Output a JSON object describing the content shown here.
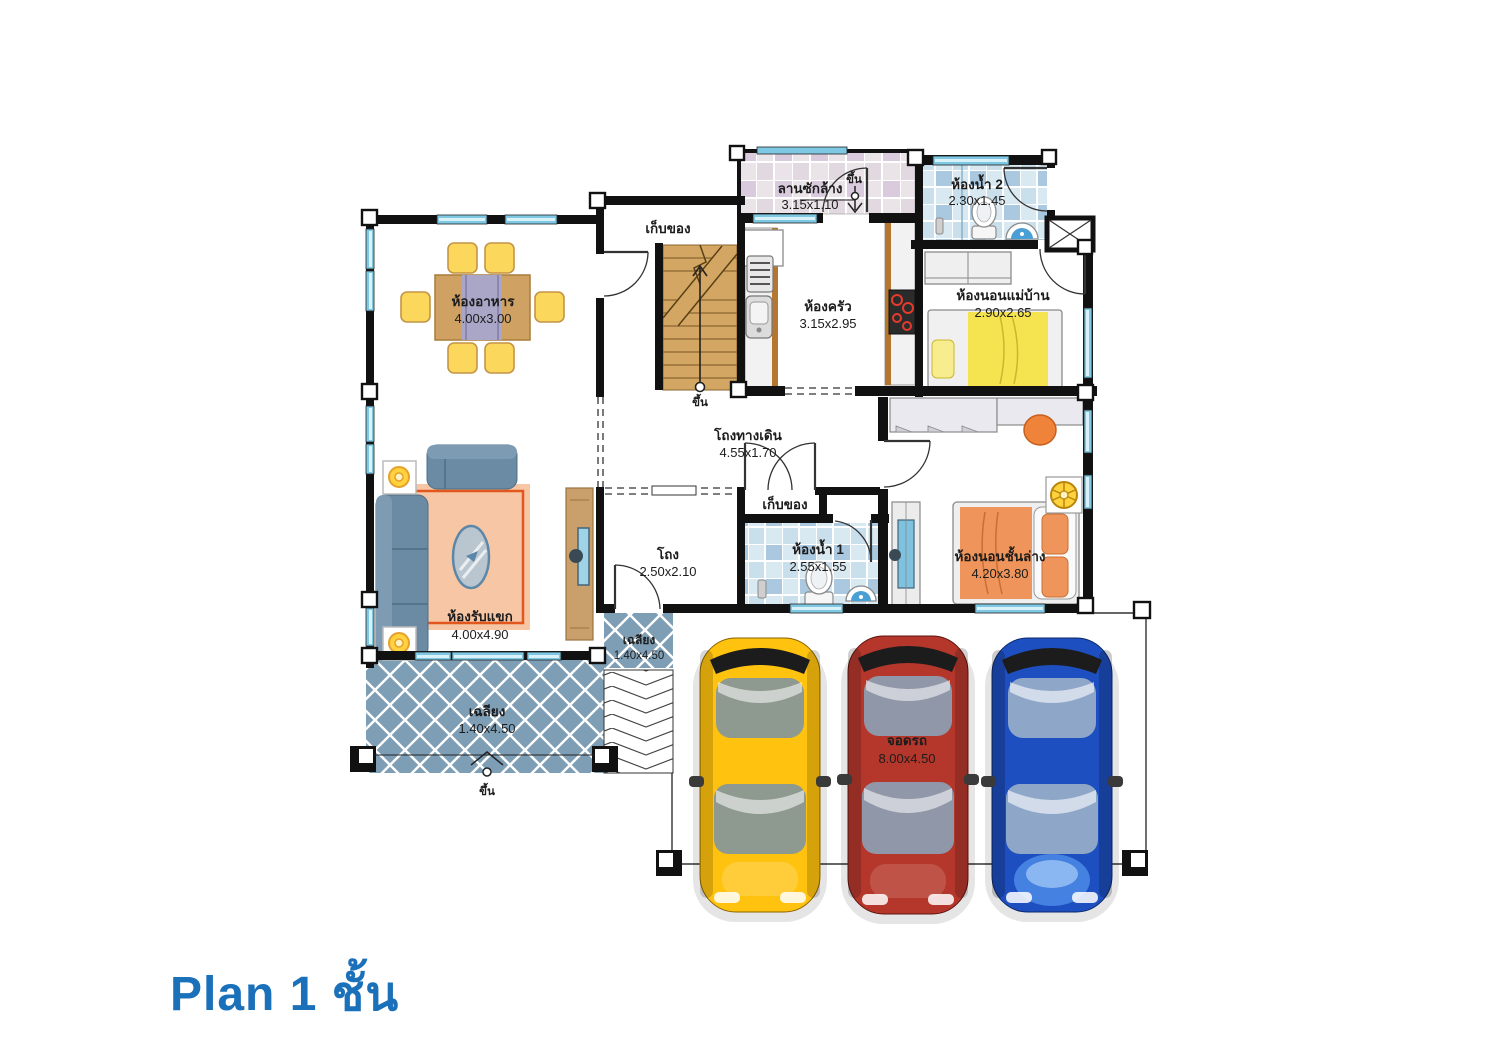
{
  "title": {
    "text": "Plan 1 ชั้น"
  },
  "rooms": {
    "laundry": {
      "name": "ลานซักล้าง",
      "dims": "3.15x1.10"
    },
    "bathroom2": {
      "name": "ห้องน้ำ 2",
      "dims": "2.30x1.45"
    },
    "storage_top": {
      "name": "เก็บของ"
    },
    "kitchen": {
      "name": "ห้องครัว",
      "dims": "3.15x2.95"
    },
    "maid_bedroom": {
      "name": "ห้องนอนแม่บ้าน",
      "dims": "2.90x2.65"
    },
    "dining": {
      "name": "ห้องอาหาร",
      "dims": "4.00x3.00"
    },
    "corridor": {
      "name": "โถงทางเดิน",
      "dims": "4.55x1.70"
    },
    "storage_mid": {
      "name": "เก็บของ"
    },
    "hall": {
      "name": "โถง",
      "dims": "2.50x2.10"
    },
    "bathroom1": {
      "name": "ห้องน้ำ 1",
      "dims": "2.55x1.55"
    },
    "bedroom_ground": {
      "name": "ห้องนอนชั้นล่าง",
      "dims": "4.20x3.80"
    },
    "living": {
      "name": "ห้องรับแขก",
      "dims": "4.00x4.90"
    },
    "porch_side": {
      "name": "เฉลียง",
      "dims": "1.40x4.50"
    },
    "porch_front": {
      "name": "เฉลียง",
      "dims": "1.40x4.50"
    },
    "parking": {
      "name": "จอดรถ",
      "dims": "8.00x4.50"
    }
  },
  "labels": {
    "up": "ขึ้น"
  },
  "colors": {
    "title_blue": "#1b70ba",
    "wall": "#111111",
    "window": "#a9dcee",
    "porch_tile": "#7e9eb6",
    "bath_tile": "#d8e9f2",
    "laundry_tile": "#eae4e8",
    "wood": "#d2a76a",
    "accent_orange": "#e2571d",
    "car_yellow": "#ffc20e",
    "car_red": "#b5372b",
    "car_blue": "#1d4fc0"
  }
}
